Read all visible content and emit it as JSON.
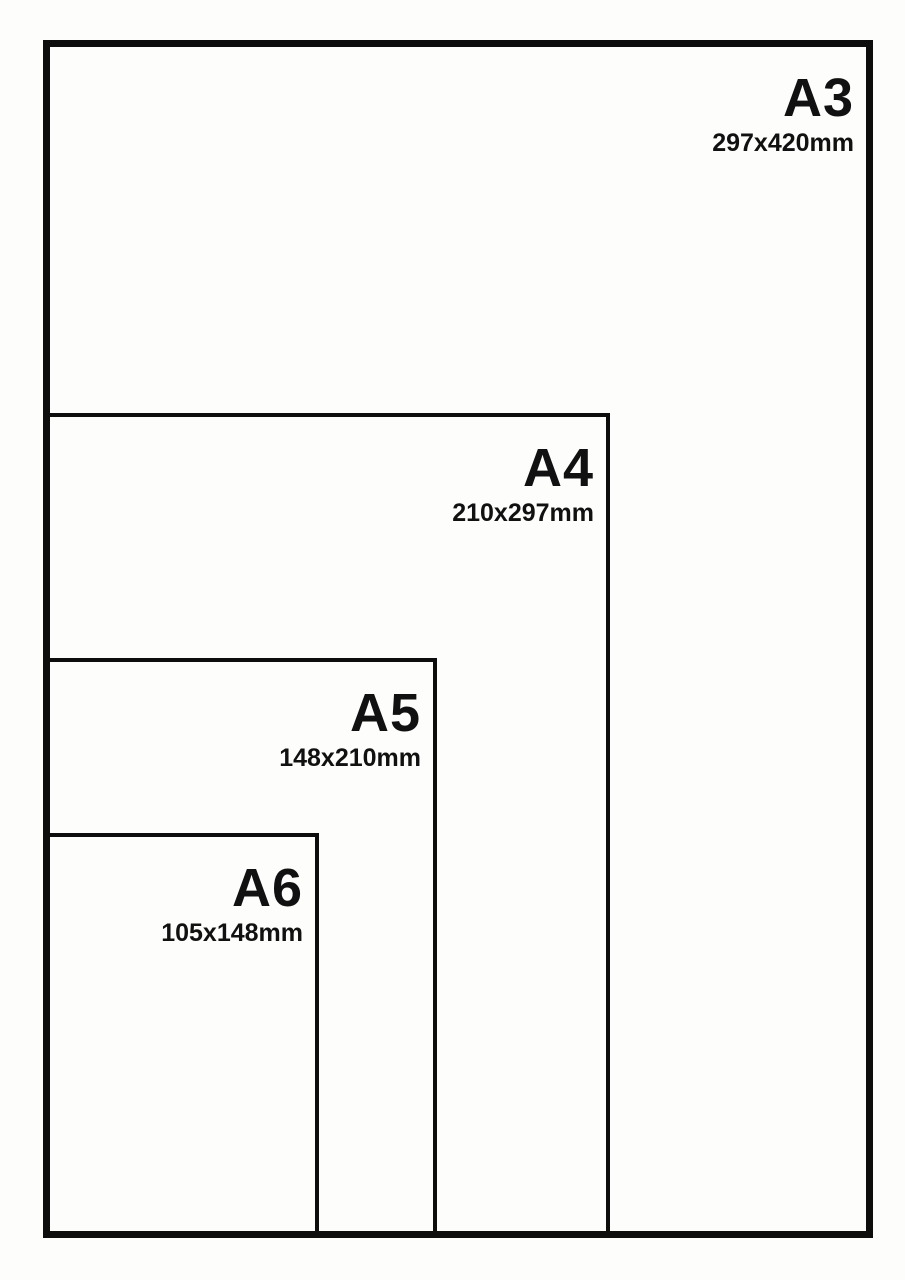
{
  "theme": {
    "background": "#fdfdfb",
    "line_color": "#0d0d0d",
    "text_color": "#111111"
  },
  "diagram": {
    "description": "Nested paper size comparison diagram"
  },
  "sizes": [
    {
      "id": "a3",
      "label": "A3",
      "dimensions": "297x420mm"
    },
    {
      "id": "a4",
      "label": "A4",
      "dimensions": "210x297mm"
    },
    {
      "id": "a5",
      "label": "A5",
      "dimensions": "148x210mm"
    },
    {
      "id": "a6",
      "label": "A6",
      "dimensions": "105x148mm"
    }
  ]
}
